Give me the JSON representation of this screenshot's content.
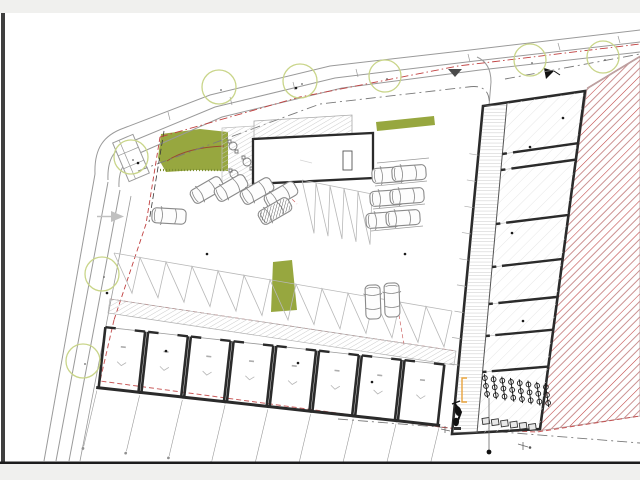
{
  "meta": {
    "title": "Scanned architectural site plan — parking court, garage row, access roads and neighbouring parcel",
    "viewer": "static page scan, no visible legible text labels"
  },
  "frame": {
    "top_bar_color": "#f0f0ee",
    "bottom_bar_color": "#f0f0ee",
    "divider_color": "#1c1c1c",
    "left_edge_color": "#3f3f3f",
    "page_color": "#ffffff"
  },
  "palette": {
    "ink": "#262626",
    "wall": "#2b2b2b",
    "gray": "#9a9a9a",
    "dim": "#8f8f8f",
    "lightgray": "#c9c9c9",
    "hatchgray": "#c6c6c6",
    "ladder": "#b3b3b3",
    "floorline": "#e3e3e3",
    "stall": "#b8b8b8",
    "red": "#c04040",
    "brick": "#cb9090",
    "brickline": "#b89898",
    "brown": "#9a4a30",
    "olive": "#97a73f",
    "olivedark": "#7d8f33",
    "tree": "#c9d589",
    "orange": "#e8a33d",
    "carline": "#8a8a8a",
    "bar": "#f0f0ee",
    "strip": "#3f3f3f",
    "divider": "#1c1c1c"
  },
  "plan": {
    "trees": [
      {
        "cx": 219,
        "cy": 87,
        "r": 17
      },
      {
        "cx": 300,
        "cy": 81,
        "r": 17
      },
      {
        "cx": 385,
        "cy": 76,
        "r": 16
      },
      {
        "cx": 530,
        "cy": 60,
        "r": 16
      },
      {
        "cx": 603,
        "cy": 57,
        "r": 16
      },
      {
        "cx": 131,
        "cy": 157,
        "r": 17
      },
      {
        "cx": 102,
        "cy": 274,
        "r": 17
      },
      {
        "cx": 83,
        "cy": 361,
        "r": 17
      }
    ],
    "cars": [
      {
        "x": 207,
        "y": 190,
        "rot": -30
      },
      {
        "x": 231,
        "y": 188,
        "rot": -30
      },
      {
        "x": 257,
        "y": 191,
        "rot": -30
      },
      {
        "x": 281,
        "y": 195,
        "rot": -30
      },
      {
        "x": 275,
        "y": 211,
        "rot": -30,
        "dark": true
      },
      {
        "x": 169,
        "y": 216,
        "rot": 3
      },
      {
        "x": 389,
        "y": 175,
        "rot": -4
      },
      {
        "x": 409,
        "y": 173,
        "rot": -4
      },
      {
        "x": 387,
        "y": 198,
        "rot": -4
      },
      {
        "x": 407,
        "y": 196,
        "rot": -4
      },
      {
        "x": 383,
        "y": 220,
        "rot": -4
      },
      {
        "x": 403,
        "y": 218,
        "rot": -4
      },
      {
        "x": 373,
        "y": 302,
        "rot": 88
      },
      {
        "x": 392,
        "y": 300,
        "rot": 88
      }
    ],
    "stalls": {
      "upper": {
        "x1": 302,
        "y1": 180,
        "x2": 372,
        "y2": 194,
        "n": 5,
        "depth": 52
      },
      "lower": {
        "x1": 114,
        "y1": 253,
        "x2": 452,
        "y2": 311,
        "n": 13,
        "depth": 38
      }
    },
    "garages": {
      "origin_x": 104,
      "origin_y": 326,
      "rotation": 6.3,
      "units": 8,
      "unit_width": 43,
      "unit_depth": 62
    },
    "right_building": {
      "corridor": {
        "a": [
          507,
          103
        ],
        "b": [
          477,
          433
        ],
        "left_a": [
          483,
          106
        ],
        "left_b": [
          452,
          434
        ],
        "right_c": [
          585,
          91
        ],
        "right_d": [
          540,
          429
        ]
      },
      "walls_left_y": [
        154,
        170,
        224,
        267,
        304,
        336,
        372
      ],
      "bike_racks": 8,
      "lockers": 6,
      "corridor_ticks": 9
    },
    "sidewalk_ticks": [
      [
        170,
        120
      ],
      [
        232,
        105
      ],
      [
        295,
        90
      ],
      [
        358,
        77
      ],
      [
        470,
        62
      ],
      [
        560,
        50
      ],
      [
        620,
        43
      ]
    ],
    "stall_dividers_right": [
      [
        377,
        163,
        429,
        158
      ],
      [
        375,
        186,
        427,
        181
      ],
      [
        373,
        209,
        425,
        204
      ],
      [
        371,
        231,
        423,
        226
      ]
    ],
    "dots": [
      [
        296,
        88
      ],
      [
        138,
        163
      ],
      [
        166,
        351
      ],
      [
        298,
        363
      ],
      [
        372,
        382
      ],
      [
        405,
        254
      ],
      [
        207,
        254
      ],
      [
        107,
        293
      ],
      [
        530,
        147
      ],
      [
        512,
        233
      ],
      [
        523,
        321
      ],
      [
        563,
        118
      ]
    ]
  }
}
